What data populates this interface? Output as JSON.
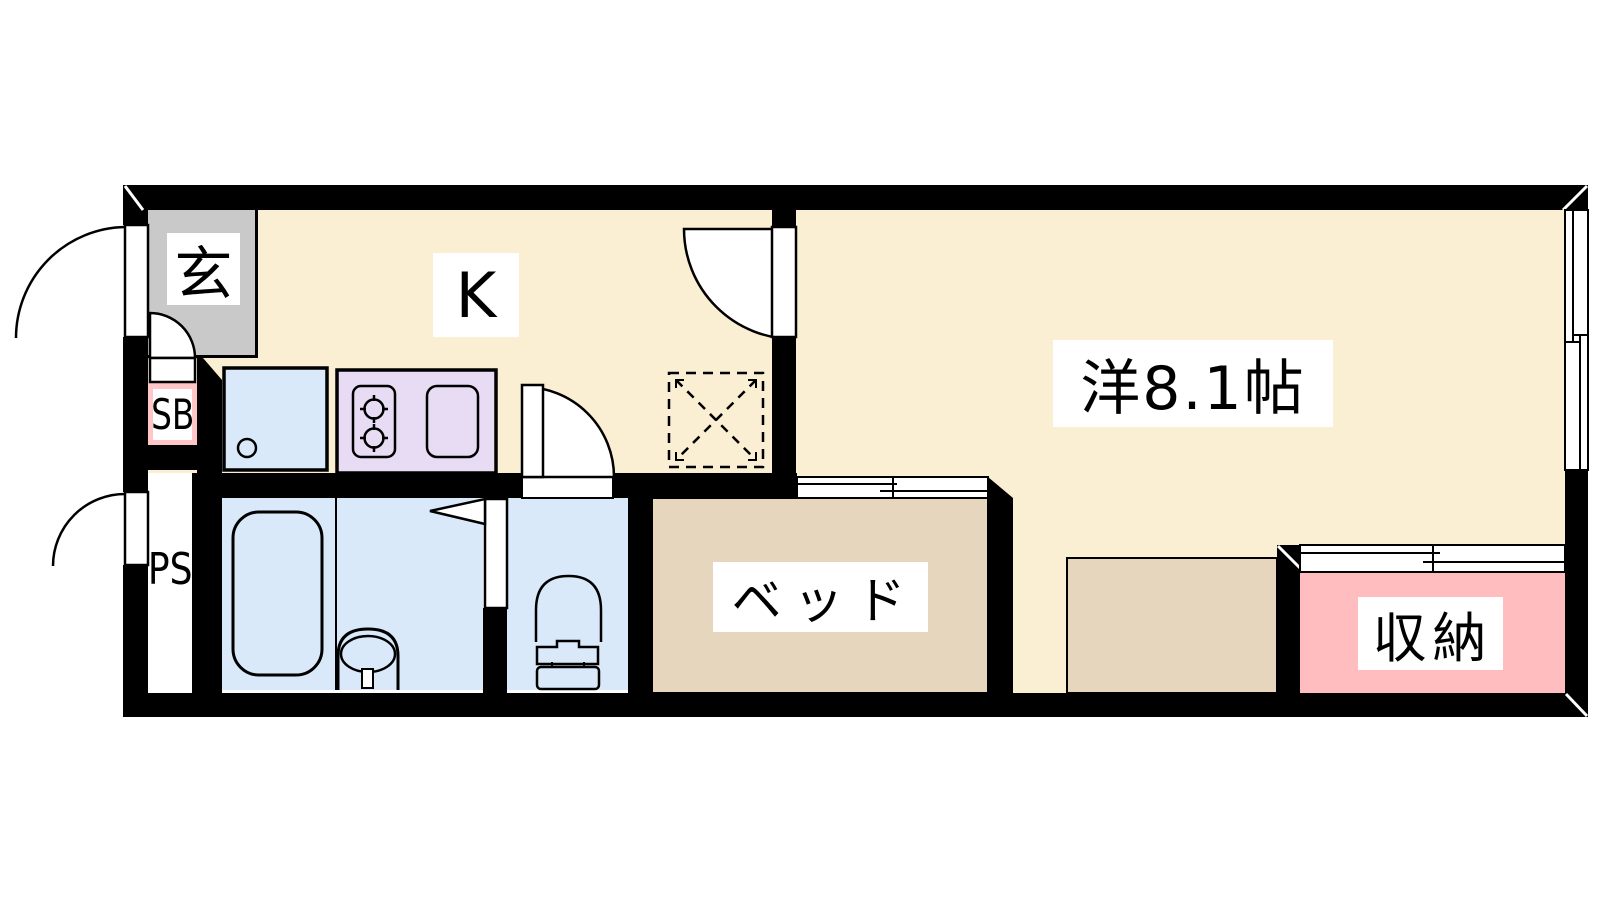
{
  "plan": {
    "title": "1K apartment floor plan",
    "rooms": {
      "genkan": {
        "label": "玄"
      },
      "kitchen": {
        "label": "K"
      },
      "western_room": {
        "label": "洋8.1帖"
      },
      "bed": {
        "label": "ベッド"
      },
      "storage": {
        "label": "収納"
      },
      "shoe_box": {
        "label": "SB"
      },
      "pipe_space": {
        "label": "PS"
      }
    },
    "colors": {
      "floor_cream": "#FAEFD2",
      "genkan_gray": "#C9C9C9",
      "water_blue": "#D9E9FA",
      "kitchen_purple": "#E7DCF3",
      "bed_tan": "#E5D6BD",
      "storage_pink": "#FFBDC0",
      "sb_pink": "#FFC5C7",
      "wall_black": "#000000",
      "label_bg": "#FFFFFF"
    }
  }
}
